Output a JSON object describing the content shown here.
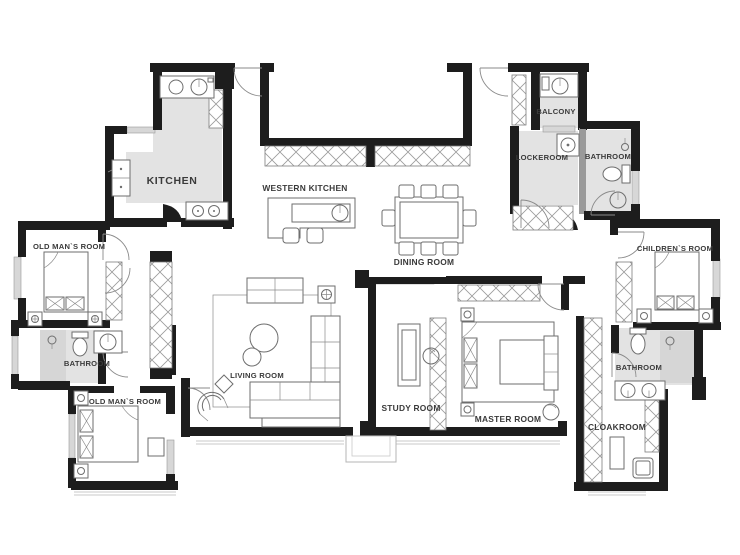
{
  "plan": {
    "type": "apartment-floor-plan",
    "rooms": {
      "kitchen": {
        "label": "KITCHEN"
      },
      "western_kitchen": {
        "label": "WESTERN KITCHEN"
      },
      "dining_room": {
        "label": "DINING ROOM"
      },
      "old_mans_room_top": {
        "label": "OLD MAN`S ROOM"
      },
      "bathroom_left": {
        "label": "BATHROOM"
      },
      "old_mans_room_bottom": {
        "label": "OLD MAN`S ROOM"
      },
      "living_room": {
        "label": "LIVING ROOM"
      },
      "study_room": {
        "label": "STUDY ROOM"
      },
      "master_room": {
        "label": "MASTER ROOM"
      },
      "cloakroom": {
        "label": "CLOAKROOM"
      },
      "balcony": {
        "label": "BALCONY"
      },
      "lockeroom": {
        "label": "LOCKEROOM"
      },
      "bathroom_top_right": {
        "label": "BATHROOM"
      },
      "childrens_room": {
        "label": "CHILDREN`S ROOM"
      },
      "bathroom_right": {
        "label": "BATHROOM"
      }
    },
    "colors": {
      "wall": "#1d1d1d",
      "floor_gray": "#e3e3e3",
      "floor_dark_gray": "#d6d6d6",
      "furniture_line": "#6e6e6e",
      "hatch_line": "#9b9b9b",
      "label_text": "#3a3a3a",
      "background": "#ffffff"
    }
  }
}
